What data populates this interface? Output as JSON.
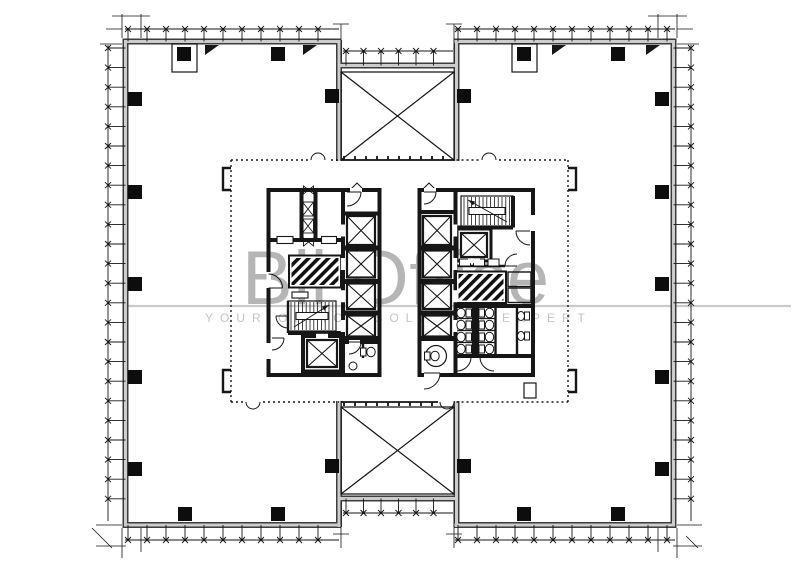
{
  "watermark": {
    "title": "Bli Office",
    "tagline": "YOUR OFFICE SOLUTION EXPERT",
    "title_color": "#b5b5b5",
    "tagline_color": "#c4c4c4",
    "rule_color": "#cacaca"
  },
  "drawing": {
    "ink_color": "#161616",
    "wall_infill_color": "#cccccc",
    "background_color": "#ffffff",
    "symbols": [
      "structural-column",
      "curtain-wall-mullion",
      "floor-void-x-brace",
      "elevator-shaft",
      "stair-run",
      "hatched-service-shaft",
      "toilet-fixture",
      "door-swing"
    ]
  }
}
